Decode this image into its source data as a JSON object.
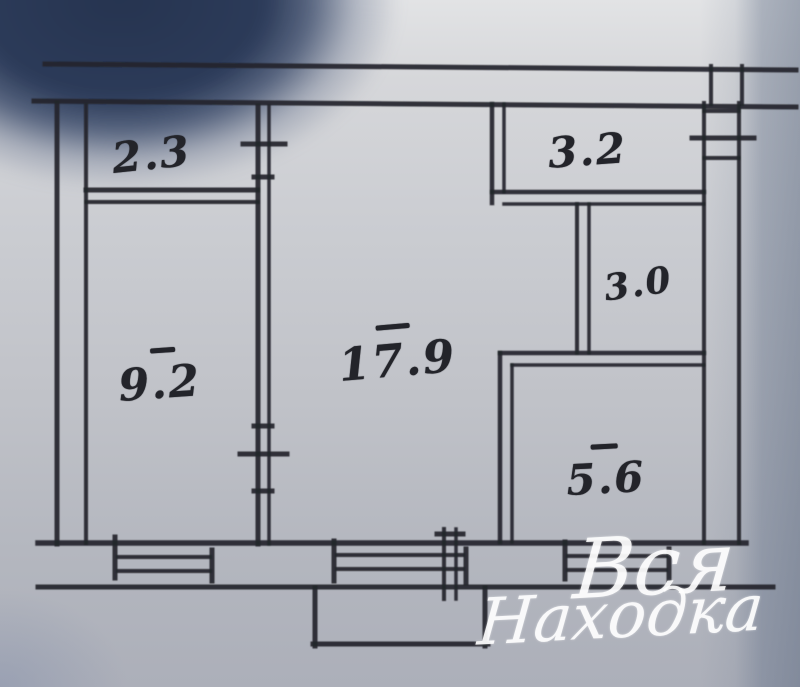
{
  "plan": {
    "description": "scanned hand-drawn apartment floor plan",
    "room_areas": [
      {
        "label": "2.3"
      },
      {
        "label": "3.2"
      },
      {
        "label": "3.0"
      },
      {
        "label": "17.9"
      },
      {
        "label": "9.2"
      },
      {
        "label": "5.6"
      }
    ],
    "watermark": {
      "line1": "Вся",
      "line2": "Находка"
    }
  },
  "colors": {
    "ink": "#24252b",
    "paper": "#c6c8cd",
    "corner_shadow": "#2c3b59",
    "right_edge_tint": "#6f8099",
    "watermark_text": "#ffffff"
  }
}
